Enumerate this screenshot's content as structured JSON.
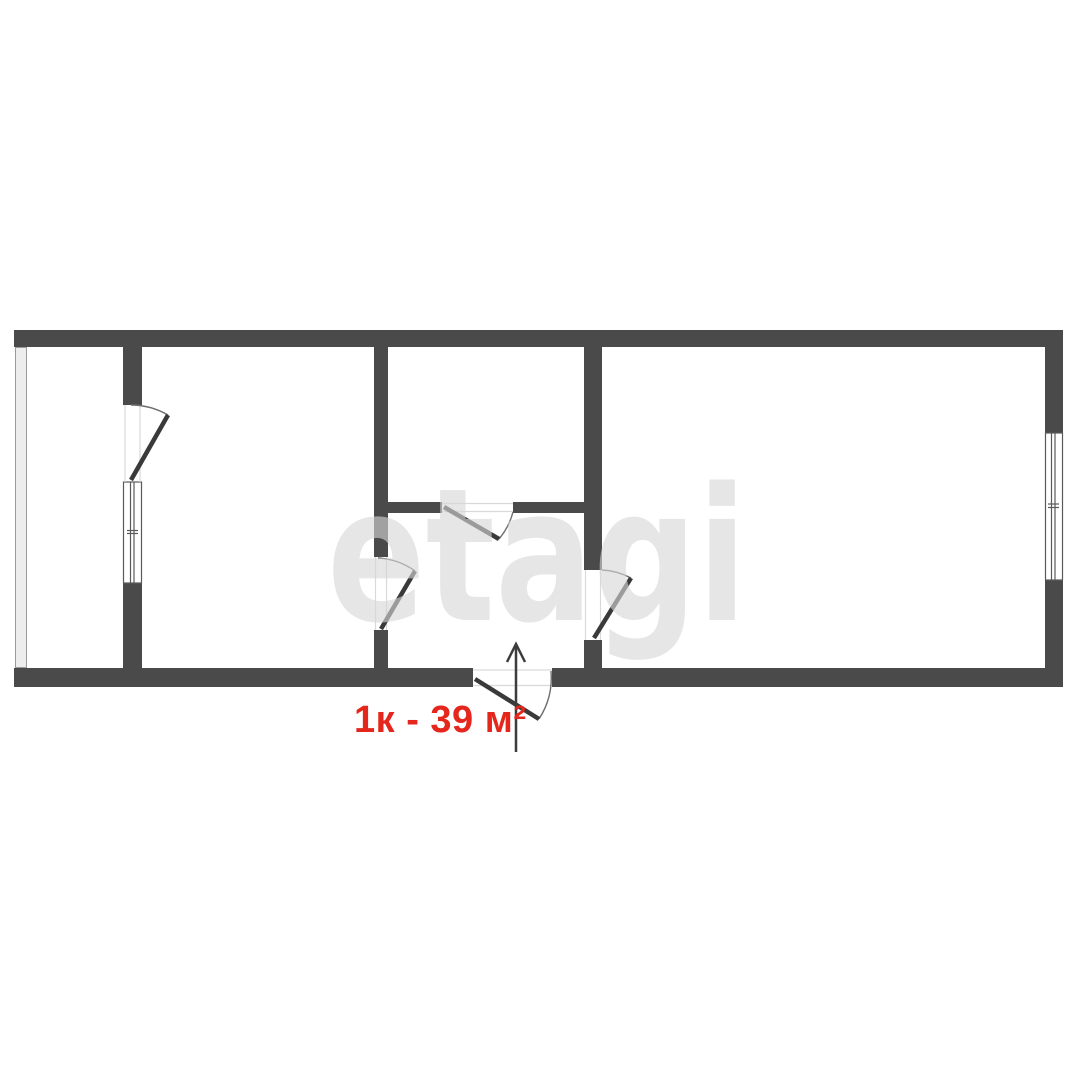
{
  "watermark": {
    "text": "etagi",
    "color": "#d6d6d6",
    "opacity": "0.62"
  },
  "label": {
    "text": "1к - 39 м²",
    "color": "#e4261c"
  },
  "plan": {
    "wall_color": "#4a4a4a",
    "door_leaf_color": "#3a3a3a",
    "arc_color": "#6e6e6e",
    "window_line_color": "#5a5a5a",
    "glazing_fill": "#ededed",
    "glazing_edge": "#9a9a9a",
    "threshold_color": "#d9d9d9",
    "arrow_color": "#3c3c3c",
    "background": "#ffffff"
  }
}
